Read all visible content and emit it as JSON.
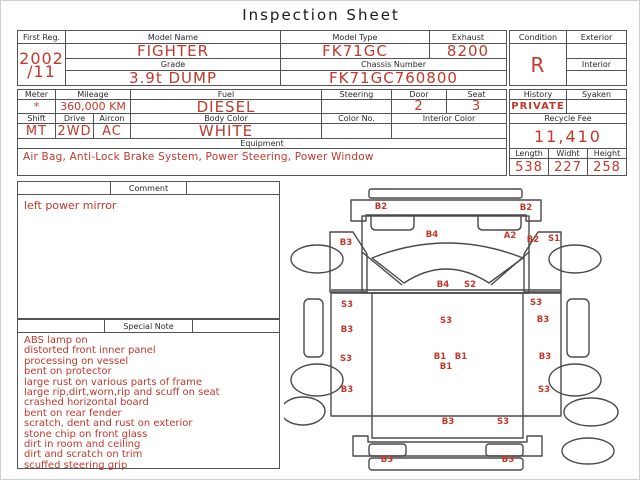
{
  "title": "Inspection Sheet",
  "colors": {
    "accent_red": "#c0392b",
    "line": "#545454"
  },
  "registration_table": {
    "first_reg": {
      "label": "First Reg.",
      "value_line1": "2002",
      "value_line2": "/11"
    },
    "model_name": {
      "label": "Model Name",
      "value": "FIGHTER"
    },
    "grade": {
      "label": "Grade",
      "value": "3.9t DUMP"
    },
    "model_type": {
      "label": "Model Type",
      "value": "FK71GC"
    },
    "exhaust": {
      "label": "Exhaust",
      "value": "8200"
    },
    "chassis_number": {
      "label": "Chassis Number",
      "value": "FK71GC760800"
    },
    "condition": {
      "label": "Condition",
      "value": "R"
    },
    "exterior": {
      "label": "Exterior",
      "value": ""
    },
    "interior": {
      "label": "Interior",
      "value": ""
    }
  },
  "spec_table": {
    "meter": {
      "label": "Meter",
      "value": "*"
    },
    "mileage": {
      "label": "Mileage",
      "value": "360,000 KM"
    },
    "fuel": {
      "label": "Fuel",
      "value": "DIESEL"
    },
    "steering": {
      "label": "Steering",
      "value": ""
    },
    "door": {
      "label": "Door",
      "value": "2"
    },
    "seat": {
      "label": "Seat",
      "value": "3"
    },
    "shift": {
      "label": "Shift",
      "value": "MT"
    },
    "drive": {
      "label": "Drive",
      "value": "2WD"
    },
    "aircon": {
      "label": "Aircon",
      "value": "AC"
    },
    "body_color": {
      "label": "Body Color",
      "value": "WHITE"
    },
    "color_no": {
      "label": "Color No.",
      "value": ""
    },
    "interior_color": {
      "label": "Interior Color",
      "value": ""
    },
    "equipment": {
      "label": "Equipment",
      "value": "Air Bag, Anti-Lock Brake System, Power Steering, Power Window"
    }
  },
  "history_table": {
    "history": {
      "label": "History",
      "value": "PRIVATE"
    },
    "syaken": {
      "label": "Syaken",
      "value": ""
    },
    "recycle_fee": {
      "label": "Recycle Fee",
      "value": "11,410"
    },
    "length": {
      "label": "Length",
      "value": "538"
    },
    "width": {
      "label": "Widht",
      "value": "227"
    },
    "height": {
      "label": "Height",
      "value": "258"
    }
  },
  "comment": {
    "label": "Comment",
    "text": "left power mirror"
  },
  "special_note": {
    "label": "Special Note",
    "lines": [
      "ABS lamp on",
      "distorted front inner panel",
      "processing on vessel",
      "bent on protector",
      "large rust on various parts of frame",
      "large rip,dirt,worn,rip and scuff on seat",
      "crashed horizontal board",
      "bent on rear fender",
      "scratch, dent and rust on exterior",
      "stone chip on front glass",
      "dirt in room and ceiling",
      "dirt and scratch on trim",
      "scuffed steering grip"
    ]
  },
  "diagram": {
    "labels": [
      {
        "text": "B2",
        "x": 97,
        "y": 25
      },
      {
        "text": "B2",
        "x": 242,
        "y": 26
      },
      {
        "text": "B4",
        "x": 148,
        "y": 53
      },
      {
        "text": "A2",
        "x": 226,
        "y": 54
      },
      {
        "text": "B2",
        "x": 249,
        "y": 58
      },
      {
        "text": "S1",
        "x": 270,
        "y": 57
      },
      {
        "text": "B3",
        "x": 62,
        "y": 61
      },
      {
        "text": "B4",
        "x": 159,
        "y": 103
      },
      {
        "text": "S2",
        "x": 186,
        "y": 103
      },
      {
        "text": "S3",
        "x": 63,
        "y": 123
      },
      {
        "text": "S3",
        "x": 252,
        "y": 121
      },
      {
        "text": "S3",
        "x": 162,
        "y": 139
      },
      {
        "text": "B3",
        "x": 63,
        "y": 148
      },
      {
        "text": "B3",
        "x": 259,
        "y": 138
      },
      {
        "text": "S3",
        "x": 62,
        "y": 177
      },
      {
        "text": "B3",
        "x": 261,
        "y": 175
      },
      {
        "text": "B1",
        "x": 156,
        "y": 175
      },
      {
        "text": "B1",
        "x": 177,
        "y": 175
      },
      {
        "text": "B1",
        "x": 162,
        "y": 185
      },
      {
        "text": "B3",
        "x": 63,
        "y": 208
      },
      {
        "text": "S3",
        "x": 260,
        "y": 208
      },
      {
        "text": "B3",
        "x": 164,
        "y": 240
      },
      {
        "text": "S3",
        "x": 219,
        "y": 240
      },
      {
        "text": "B3",
        "x": 103,
        "y": 278
      },
      {
        "text": "B3",
        "x": 224,
        "y": 278
      }
    ]
  }
}
